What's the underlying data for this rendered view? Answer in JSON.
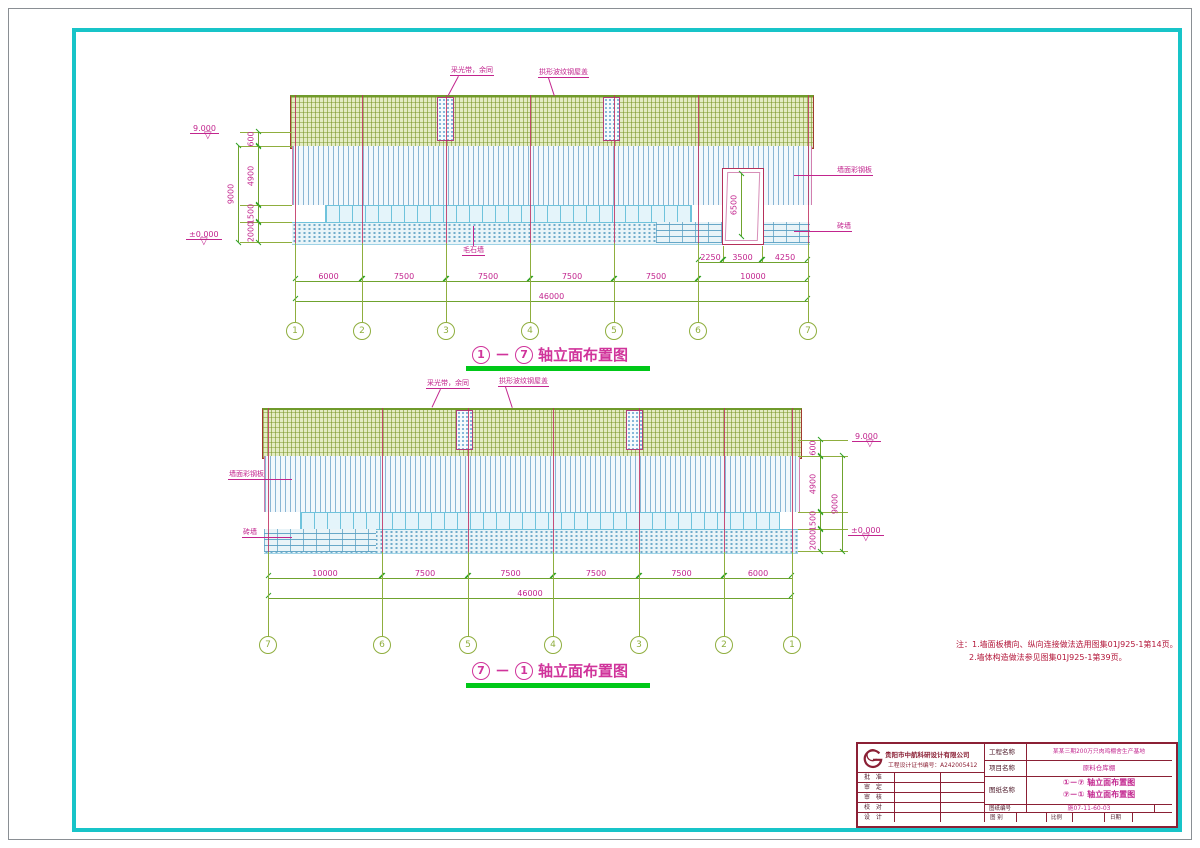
{
  "elev1": {
    "levels": {
      "top": "9.000",
      "zero": "±0.000"
    },
    "dims_left": [
      "600",
      "4900",
      "1500",
      "2000",
      "9000"
    ],
    "dims_sub": [
      "2250",
      "3500",
      "4250"
    ],
    "dims_bays": [
      "6000",
      "7500",
      "7500",
      "7500",
      "7500",
      "10000"
    ],
    "dim_total": "46000",
    "door_height": "6500",
    "axes": [
      "1",
      "2",
      "3",
      "4",
      "5",
      "6",
      "7"
    ],
    "labels": {
      "skylight": "采光带，余同",
      "roof": "拱形波纹钢屋盖",
      "wall_panel": "墙面彩钢板",
      "brick_wall": "砖墙",
      "base_wall": "毛石墙"
    },
    "title": {
      "from": "1",
      "dash": "－",
      "to": "7",
      "text": "轴立面布置图"
    }
  },
  "elev2": {
    "levels": {
      "top": "9.000",
      "zero": "±0.000"
    },
    "dims_right": [
      "600",
      "4900",
      "1500",
      "2000",
      "9000"
    ],
    "dims_bays": [
      "10000",
      "7500",
      "7500",
      "7500",
      "7500",
      "6000"
    ],
    "dim_total": "46000",
    "axes": [
      "7",
      "6",
      "5",
      "4",
      "3",
      "2",
      "1"
    ],
    "labels": {
      "skylight": "采光带，余同",
      "roof": "拱形波纹钢屋盖",
      "wall_panel": "墙面彩钢板",
      "brick_wall": "砖墙"
    },
    "title": {
      "from": "7",
      "dash": "－",
      "to": "1",
      "text": "轴立面布置图"
    }
  },
  "notes": {
    "line1": "注：1.墙面板横向、纵向连接做法选用图集01J925-1第14页。",
    "line2": "2.墙体构造做法参见图集01J925-1第39页。"
  },
  "titleblock": {
    "company": "贵阳市中航科研设计有限公司",
    "cert": "工程设计证书编号：A242005412",
    "sign_rows": [
      "批 准",
      "审 定",
      "审 核",
      "校 对",
      "设 计"
    ],
    "fields": {
      "project_label": "工程名称",
      "project_value": "某某三期200万只肉鸡棚舍生产基地",
      "item_label": "项目名称",
      "item_value": "原料仓库棚",
      "drawing_label": "图纸名称",
      "drawing_value_1": "①－⑦ 轴立面布置图",
      "drawing_value_2": "⑦－① 轴立面布置图",
      "number_label": "图纸编号",
      "number_value": "施07-11-60-03",
      "type_label": "图 别",
      "scale_label": "比例",
      "date_label": "日期"
    }
  }
}
